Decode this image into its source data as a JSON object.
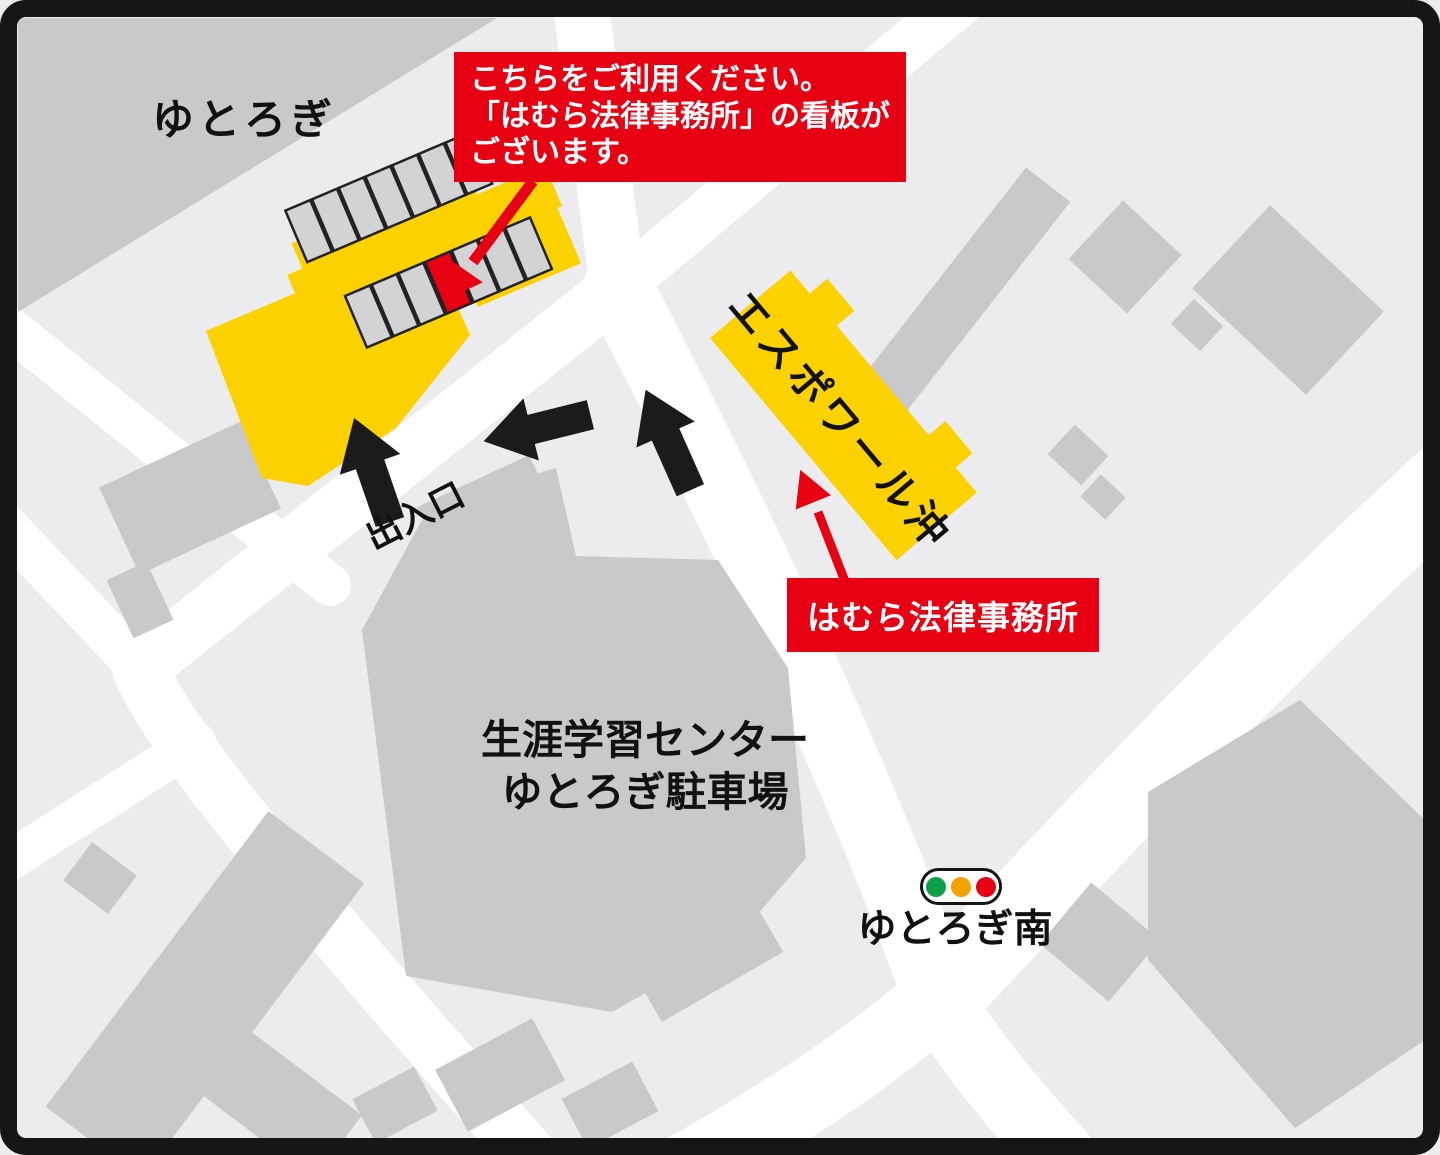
{
  "map": {
    "title_region": "羽村市 ゆとろぎ周辺 駐車場案内図",
    "labels": {
      "yutorogi": "ゆとろぎ",
      "entrance": "出入口",
      "espoir_oki": "エスポワール沖",
      "learning_center_line1": "生涯学習センター",
      "learning_center_line2": "ゆとろぎ駐車場",
      "yutorogi_minami": "ゆとろぎ南"
    },
    "callouts": {
      "parking_note_line1": "こちらをご利用ください。",
      "parking_note_line2": "「はむら法律事務所」の看板が",
      "parking_note_line3": "ございます。",
      "office_label": "はむら法律事務所"
    },
    "parking": {
      "top_row_stalls": 7,
      "bottom_row_stalls": 7,
      "reserved_stall_position": 4
    },
    "traffic_light": {
      "colors": [
        "#0f9e49",
        "#f3a200",
        "#e50012"
      ]
    },
    "colors": {
      "lot_yellow": "#fbd100",
      "highlight_red": "#e60012",
      "building_gray": "#c9c9cb",
      "block_gray": "#ececee",
      "road_white": "#ffffff",
      "arrow_black": "#1b1b1b",
      "frame_black": "#161616"
    }
  }
}
